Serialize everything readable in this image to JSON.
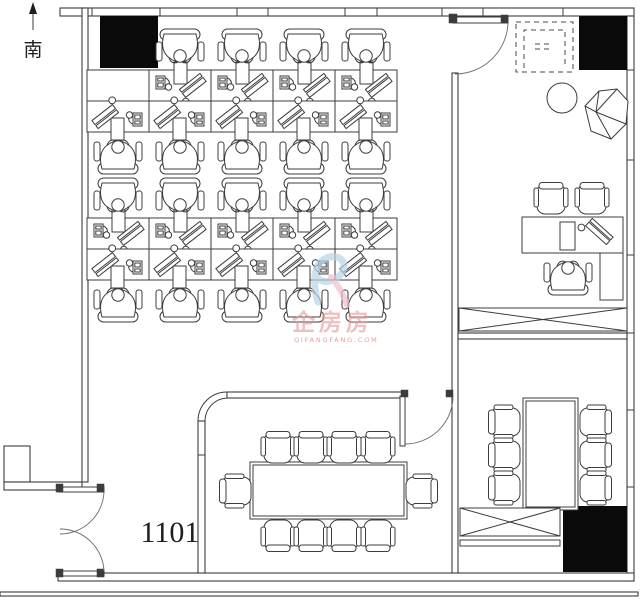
{
  "compass": {
    "direction_label": "南"
  },
  "unit": {
    "room_number": "1101"
  },
  "watermark": {
    "brand": "企房房",
    "tagline": "QIFANGFANG.COM"
  },
  "colors": {
    "line": "#3c3c3c",
    "column_fill": "#0a0a0a",
    "watermark_brand": "#e59c9c",
    "watermark_tagline": "#dd5555",
    "watermark_logo_blue": "#b9d3e6",
    "watermark_logo_pink": "#efbfcd"
  },
  "furniture_summary": {
    "open_office_workstations": 19,
    "conference_room_seats": 10,
    "meeting_room_seats": 6,
    "executive_guest_chairs": 2,
    "executive_desks": 1,
    "structural_columns": 3
  }
}
